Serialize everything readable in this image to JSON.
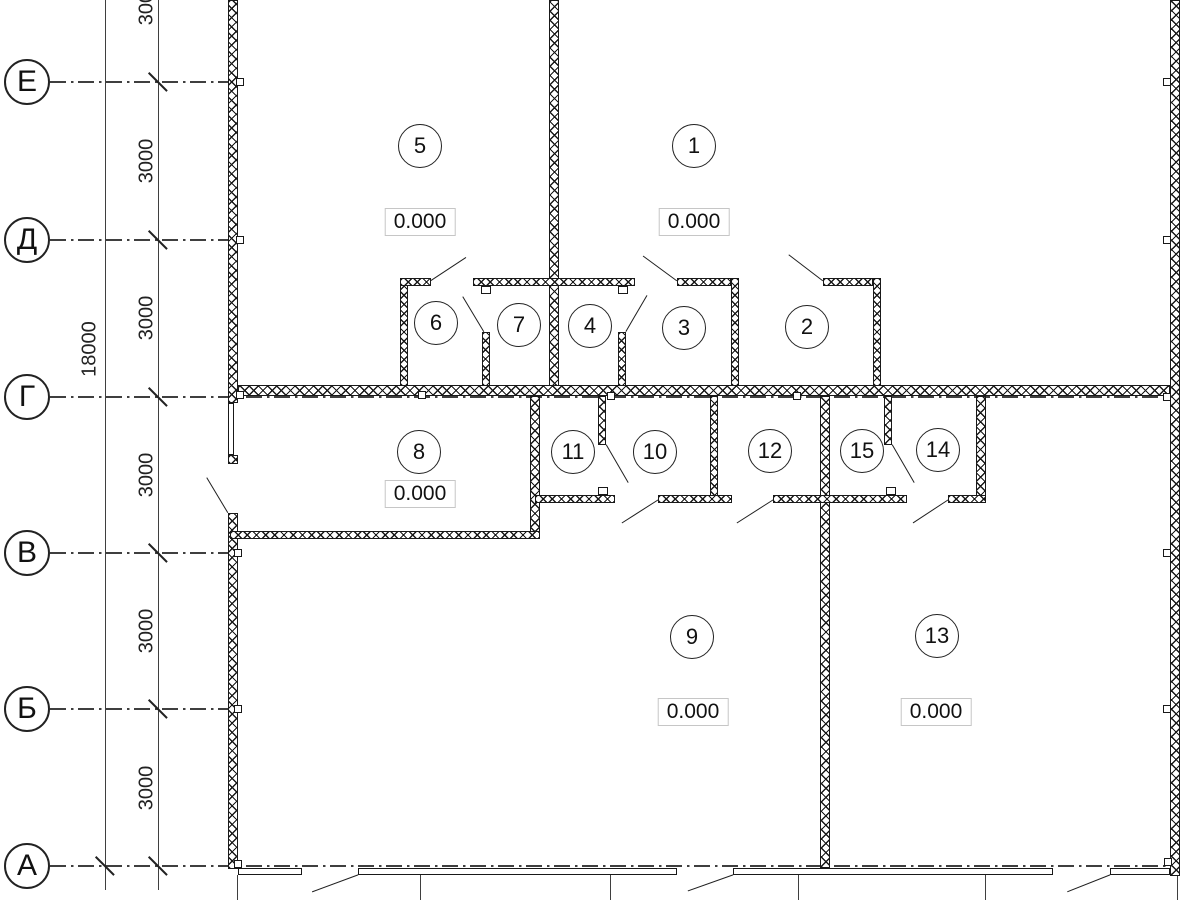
{
  "drawing": {
    "type": "architectural-floor-plan",
    "background": "#ffffff",
    "wall_color": "#191919",
    "axis_line_color": "#3f3f3f",
    "elevation_box_border": "#c6c6c6"
  },
  "dimensions": {
    "overall": {
      "text": "18000",
      "x": 90,
      "y": 349
    },
    "segment_texts": [
      {
        "text": "3000",
        "x": 147,
        "y": 3
      },
      {
        "text": "3000",
        "x": 147,
        "y": 161
      },
      {
        "text": "3000",
        "x": 147,
        "y": 318
      },
      {
        "text": "3000",
        "x": 147,
        "y": 475
      },
      {
        "text": "3000",
        "x": 147,
        "y": 631
      },
      {
        "text": "3000",
        "x": 147,
        "y": 788
      }
    ],
    "dim_lines": {
      "overall_x": 105,
      "segment_x": 158,
      "y1": 0,
      "y2": 890
    },
    "ticks_segment_line": [
      82,
      240,
      397,
      553,
      709,
      866
    ],
    "ticks_overall_line": [
      866
    ]
  },
  "axes": {
    "bubble_left": 4,
    "items": [
      {
        "label": "Е",
        "y": 82,
        "extent": 238
      },
      {
        "label": "Д",
        "y": 240,
        "extent": 238
      },
      {
        "label": "Г",
        "y": 397,
        "extent": 1180
      },
      {
        "label": "В",
        "y": 553,
        "extent": 238
      },
      {
        "label": "Б",
        "y": 709,
        "extent": 238
      },
      {
        "label": "А",
        "y": 866,
        "extent": 1180
      }
    ]
  },
  "rooms": [
    {
      "number": "5",
      "cx": 420,
      "cy": 146
    },
    {
      "number": "1",
      "cx": 694,
      "cy": 146
    },
    {
      "number": "6",
      "cx": 436,
      "cy": 323
    },
    {
      "number": "7",
      "cx": 519,
      "cy": 325
    },
    {
      "number": "4",
      "cx": 590,
      "cy": 326
    },
    {
      "number": "3",
      "cx": 684,
      "cy": 328
    },
    {
      "number": "2",
      "cx": 807,
      "cy": 327
    },
    {
      "number": "8",
      "cx": 419,
      "cy": 452
    },
    {
      "number": "11",
      "cx": 573,
      "cy": 452
    },
    {
      "number": "10",
      "cx": 655,
      "cy": 452
    },
    {
      "number": "12",
      "cx": 770,
      "cy": 451
    },
    {
      "number": "15",
      "cx": 862,
      "cy": 451
    },
    {
      "number": "14",
      "cx": 938,
      "cy": 450
    },
    {
      "number": "9",
      "cx": 692,
      "cy": 637
    },
    {
      "number": "13",
      "cx": 937,
      "cy": 636
    }
  ],
  "elevations": {
    "value": "0.000",
    "positions": [
      {
        "room": "5",
        "x": 420,
        "y": 222
      },
      {
        "room": "1",
        "x": 694,
        "y": 222
      },
      {
        "room": "8",
        "x": 420,
        "y": 494
      },
      {
        "room": "9",
        "x": 693,
        "y": 712
      },
      {
        "room": "13",
        "x": 936,
        "y": 712
      }
    ]
  },
  "walls": [
    {
      "name": "left-wall-upper",
      "x": 228,
      "y": 0,
      "w": 10,
      "h": 403
    },
    {
      "name": "left-wall-pier",
      "x": 228,
      "y": 455,
      "w": 10,
      "h": 9
    },
    {
      "name": "left-wall-lower",
      "x": 228,
      "y": 513,
      "w": 10,
      "h": 356
    },
    {
      "name": "right-wall",
      "x": 1170,
      "y": 0,
      "w": 10,
      "h": 876
    },
    {
      "name": "center-wall",
      "x": 549,
      "y": 0,
      "w": 10,
      "h": 390
    },
    {
      "name": "axis-g-wall",
      "x": 238,
      "y": 385,
      "w": 932,
      "h": 11
    },
    {
      "name": "room6-left-wall",
      "x": 400,
      "y": 278,
      "w": 8,
      "h": 108
    },
    {
      "name": "upper-top-wall-1",
      "x": 400,
      "y": 278,
      "w": 31,
      "h": 8
    },
    {
      "name": "upper-top-wall-2",
      "x": 473,
      "y": 278,
      "w": 162,
      "h": 8
    },
    {
      "name": "upper-top-wall-3",
      "x": 677,
      "y": 278,
      "w": 54,
      "h": 8
    },
    {
      "name": "upper-top-wall-4",
      "x": 823,
      "y": 278,
      "w": 50,
      "h": 8
    },
    {
      "name": "partition-6-7",
      "x": 482,
      "y": 332,
      "w": 8,
      "h": 54
    },
    {
      "name": "partition-4-3",
      "x": 618,
      "y": 332,
      "w": 8,
      "h": 54
    },
    {
      "name": "wall-3-2",
      "x": 731,
      "y": 278,
      "w": 8,
      "h": 108
    },
    {
      "name": "room2-right-wall",
      "x": 873,
      "y": 278,
      "w": 8,
      "h": 108
    },
    {
      "name": "room8-right-wall",
      "x": 530,
      "y": 396,
      "w": 10,
      "h": 143
    },
    {
      "name": "partition-11-10",
      "x": 598,
      "y": 396,
      "w": 8,
      "h": 49
    },
    {
      "name": "wall-10-12",
      "x": 710,
      "y": 396,
      "w": 8,
      "h": 107
    },
    {
      "name": "wall-9-13",
      "x": 820,
      "y": 396,
      "w": 10,
      "h": 472
    },
    {
      "name": "partition-15-14",
      "x": 884,
      "y": 396,
      "w": 8,
      "h": 49
    },
    {
      "name": "room14-right-wall",
      "x": 976,
      "y": 396,
      "w": 10,
      "h": 107
    },
    {
      "name": "lower-bottom-wall-1",
      "x": 535,
      "y": 495,
      "w": 80,
      "h": 8
    },
    {
      "name": "lower-bottom-wall-2",
      "x": 658,
      "y": 495,
      "w": 74,
      "h": 8
    },
    {
      "name": "lower-bottom-wall-3",
      "x": 773,
      "y": 495,
      "w": 134,
      "h": 8
    },
    {
      "name": "lower-bottom-wall-4",
      "x": 948,
      "y": 495,
      "w": 38,
      "h": 8
    },
    {
      "name": "room8-bottom-wall",
      "x": 230,
      "y": 531,
      "w": 310,
      "h": 8
    }
  ],
  "windows": [
    {
      "name": "left-window",
      "x": 228,
      "y": 403,
      "w": 6,
      "h": 52
    },
    {
      "name": "bottom-window-1",
      "x": 238,
      "y": 868,
      "w": 64,
      "h": 7
    },
    {
      "name": "bottom-window-2",
      "x": 358,
      "y": 868,
      "w": 319,
      "h": 7
    },
    {
      "name": "bottom-window-3",
      "x": 733,
      "y": 868,
      "w": 320,
      "h": 7
    },
    {
      "name": "bottom-window-4",
      "x": 1110,
      "y": 868,
      "w": 60,
      "h": 7
    }
  ],
  "door_swings": [
    {
      "x1": 431,
      "y1": 281,
      "x2": 466,
      "y2": 258
    },
    {
      "x1": 677,
      "y1": 281,
      "x2": 643,
      "y2": 256
    },
    {
      "x1": 823,
      "y1": 281,
      "x2": 789,
      "y2": 255
    },
    {
      "x1": 484,
      "y1": 332,
      "x2": 463,
      "y2": 297
    },
    {
      "x1": 626,
      "y1": 332,
      "x2": 647,
      "y2": 296
    },
    {
      "x1": 606,
      "y1": 445,
      "x2": 628,
      "y2": 483
    },
    {
      "x1": 892,
      "y1": 445,
      "x2": 914,
      "y2": 483
    },
    {
      "x1": 658,
      "y1": 500,
      "x2": 622,
      "y2": 523
    },
    {
      "x1": 773,
      "y1": 500,
      "x2": 737,
      "y2": 523
    },
    {
      "x1": 948,
      "y1": 500,
      "x2": 913,
      "y2": 523
    },
    {
      "x1": 228,
      "y1": 513,
      "x2": 207,
      "y2": 478
    },
    {
      "x1": 358,
      "y1": 875,
      "x2": 312,
      "y2": 892
    },
    {
      "x1": 733,
      "y1": 875,
      "x2": 688,
      "y2": 891
    },
    {
      "x1": 1110,
      "y1": 875,
      "x2": 1067,
      "y2": 892
    }
  ],
  "column_marks": [
    {
      "x": 236,
      "y": 78
    },
    {
      "x": 236,
      "y": 236
    },
    {
      "x": 236,
      "y": 391
    },
    {
      "x": 234,
      "y": 549
    },
    {
      "x": 234,
      "y": 705
    },
    {
      "x": 234,
      "y": 860
    },
    {
      "x": 1163,
      "y": 78
    },
    {
      "x": 1163,
      "y": 236
    },
    {
      "x": 1163,
      "y": 393
    },
    {
      "x": 1163,
      "y": 549
    },
    {
      "x": 1163,
      "y": 705
    },
    {
      "x": 1164,
      "y": 858
    },
    {
      "x": 418,
      "y": 391
    },
    {
      "x": 607,
      "y": 392
    },
    {
      "x": 793,
      "y": 392
    }
  ],
  "door_stops": [
    {
      "x": 481,
      "y": 286
    },
    {
      "x": 618,
      "y": 286
    },
    {
      "x": 598,
      "y": 487
    },
    {
      "x": 886,
      "y": 487
    }
  ],
  "grid_stubs": {
    "y1": 875,
    "y2": 900,
    "xs": [
      237,
      420,
      610,
      798,
      985,
      1177
    ]
  }
}
